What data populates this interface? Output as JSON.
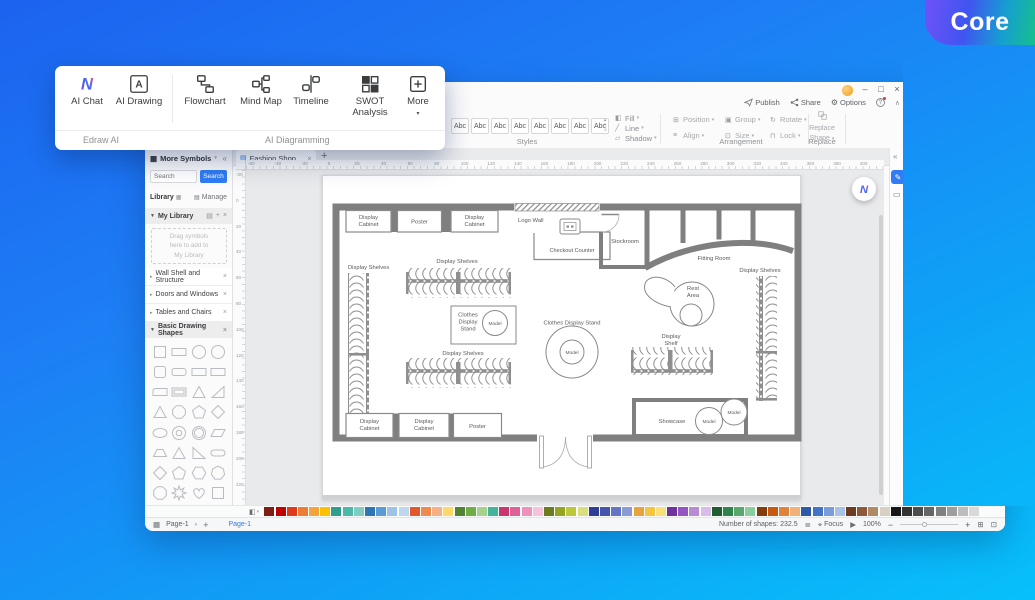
{
  "core_badge": {
    "label": "Core"
  },
  "overlay": {
    "group1_label": "Edraw AI",
    "group2_label": "AI Diagramming",
    "buttons": {
      "ai_chat": "AI Chat",
      "ai_drawing": "AI Drawing",
      "flowchart": "Flowchart",
      "mind_map": "Mind Map",
      "timeline": "Timeline",
      "swot": "SWOT Analysis",
      "more": "More"
    }
  },
  "titlebar": {
    "minimize": "–",
    "maximize": "□",
    "close": "×"
  },
  "quickbar": {
    "publish": "Publish",
    "share": "Share",
    "options": "Options",
    "help": "?"
  },
  "ribbon": {
    "style_samples": [
      "Abc",
      "Abc",
      "Abc",
      "Abc",
      "Abc",
      "Abc",
      "Abc",
      "Abc"
    ],
    "styles_label": "Styles",
    "fill": "Fill",
    "line": "Line",
    "shadow": "Shadow",
    "arrangement": [
      "Position",
      "Align",
      "Group",
      "Size",
      "Rotate",
      "Lock"
    ],
    "arrangement_label": "Arrangement",
    "replace_line1": "Replace",
    "replace_line2": "Shape",
    "replace_label": "Replace"
  },
  "tabs": {
    "doc_title": "Fashion Shop ...",
    "close": "×",
    "add": "+"
  },
  "sidebar": {
    "header": "More Symbols",
    "search_placeholder": "Search",
    "search_button": "Search",
    "library_label": "Library",
    "manage_label": "Manage",
    "my_library": "My Library",
    "drop_hint": [
      "Drag symbols",
      "here to add to",
      "My Library"
    ],
    "sections": [
      "Wall Shell and Structure",
      "Doors and Windows",
      "Tables and Chairs"
    ],
    "basic_section": "Basic Drawing Shapes",
    "shapes": [
      "square",
      "rect",
      "circle",
      "circle",
      "square-round",
      "rect-round",
      "rect",
      "rect",
      "rect-corner",
      "rect-frame",
      "triangle",
      "tri-right",
      "triangle",
      "octagon",
      "pentagon",
      "diamond",
      "ellipse",
      "donut",
      "ring",
      "parallelogram",
      "trapezoid",
      "triangle",
      "tri-right2",
      "pill",
      "diamond",
      "pentagon",
      "hexagon",
      "heptagon",
      "octagon",
      "star8",
      "heart",
      "square"
    ]
  },
  "ruler": {
    "h": [
      "-60",
      "-40",
      "-20",
      "0",
      "20",
      "40",
      "60",
      "80",
      "100",
      "120",
      "140",
      "160",
      "180",
      "200",
      "220",
      "240",
      "260",
      "280",
      "300",
      "320",
      "340",
      "360",
      "380",
      "400"
    ],
    "v": [
      "-20",
      "0",
      "20",
      "40",
      "60",
      "80",
      "100",
      "120",
      "140",
      "160",
      "180",
      "200",
      "220"
    ]
  },
  "floorplan": {
    "labels": {
      "display": "Display",
      "cabinet": "Cabinet",
      "poster": "Poster",
      "logo_wall": "Logo Wall",
      "checkout": "Checkout Counter",
      "stockroom": "Stockroom",
      "fitting": "Fitting Room",
      "display_shelves": "Display Shelves",
      "shelf": "Shelf",
      "clothes": "Clothes",
      "stand": "Stand",
      "clothes_display_stand": "Clothes Display Stand",
      "model": "Model",
      "rest": "Rest",
      "area": "Area",
      "showcase": "Showcase"
    }
  },
  "palette": {
    "colors": [
      "#7f1d10",
      "#c00000",
      "#e03a1c",
      "#ed7d31",
      "#f5a33c",
      "#ffc000",
      "#2e9e8f",
      "#4cb8a9",
      "#7fccc1",
      "#2e75b6",
      "#5b9bd5",
      "#9dc3e6",
      "#bdd7ee",
      "#e2582c",
      "#ef8a4e",
      "#f4b183",
      "#ffd966",
      "#548235",
      "#70ad47",
      "#a9d18e",
      "#43b49a",
      "#c9356f",
      "#e0609a",
      "#f091bb",
      "#f6c3da",
      "#6d7c1e",
      "#94a521",
      "#bcc93a",
      "#d9df7a",
      "#2f3d96",
      "#4455b0",
      "#6674c4",
      "#8c9ad6",
      "#e8a33d",
      "#f5c542",
      "#f9e07a",
      "#7030a0",
      "#9454c3",
      "#b98ad6",
      "#d7bde8",
      "#1e5c31",
      "#2f8549",
      "#57a86b",
      "#8ccf9f",
      "#833c0c",
      "#c55a11",
      "#e2803d",
      "#f0b27a",
      "#2e5ba8",
      "#4472c4",
      "#7b9bd9",
      "#a9c0e8",
      "#6e3b1e",
      "#8c5a3a",
      "#b08968",
      "#d9cfc4",
      "#171717",
      "#333333",
      "#4d4d4d",
      "#666666",
      "#808080",
      "#9e9e9e",
      "#bdbdbd",
      "#d9d9d9"
    ]
  },
  "statusbar": {
    "page": "Page-1",
    "add_page": "+",
    "page_tab": "Page-1",
    "shapes_count": "Number of shapes: 232.5",
    "focus": "Focus",
    "zoom": "100%"
  },
  "colors": {
    "accent": "#2f7cf6",
    "wall": "#7f7f7f"
  }
}
